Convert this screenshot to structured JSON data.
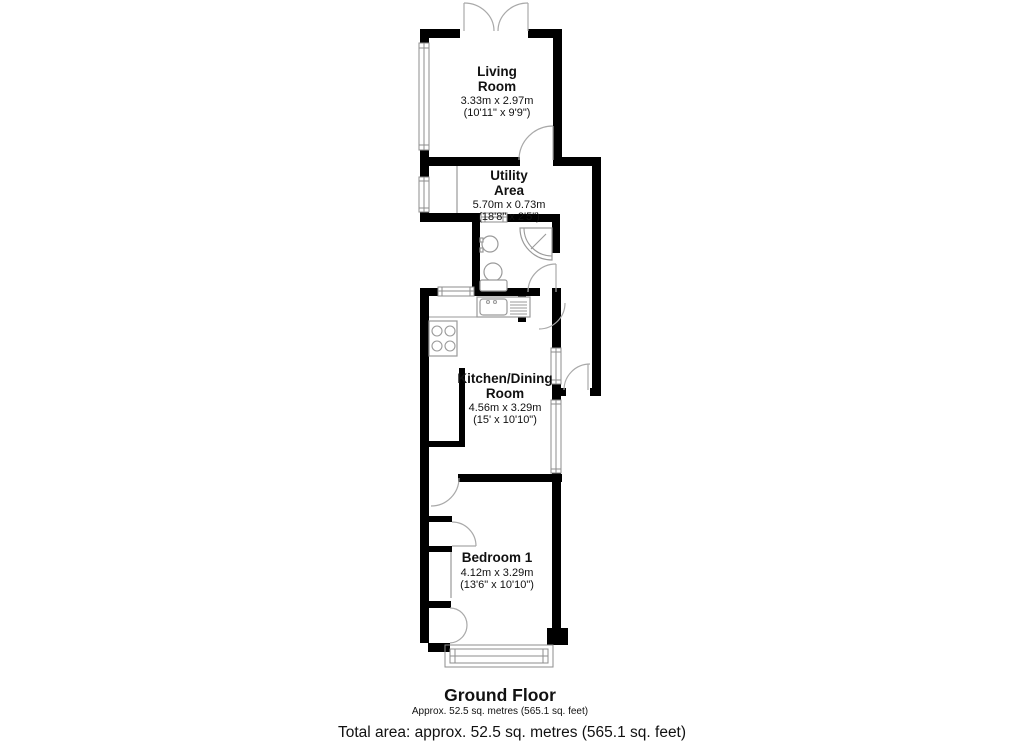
{
  "plan": {
    "rooms": [
      {
        "id": "living-room",
        "name_line1": "Living",
        "name_line2": "Room",
        "metric": "3.33m x 2.97m",
        "imperial": "(10'11\" x 9'9\")"
      },
      {
        "id": "utility-area",
        "name_line1": "Utility",
        "name_line2": "Area",
        "metric": "5.70m x 0.73m",
        "imperial": "(18'8\" x 2'5\")"
      },
      {
        "id": "kitchen-dining-room",
        "name_line1": "Kitchen/Dining",
        "name_line2": "Room",
        "metric": "4.56m x 3.29m",
        "imperial": "(15' x 10'10\")"
      },
      {
        "id": "bedroom-1",
        "name_line1": "Bedroom 1",
        "name_line2": "",
        "metric": "4.12m x 3.29m",
        "imperial": "(13'6\" x 10'10\")"
      }
    ],
    "floor": {
      "title": "Ground Floor",
      "subtitle": "Approx. 52.5 sq. metres (565.1 sq. feet)"
    },
    "total_area": "Total area: approx. 52.5 sq. metres (565.1 sq. feet)",
    "colors": {
      "wall": "#000000",
      "detail_line": "#9a9a9a",
      "text": "#111111",
      "background": "#ffffff"
    }
  }
}
